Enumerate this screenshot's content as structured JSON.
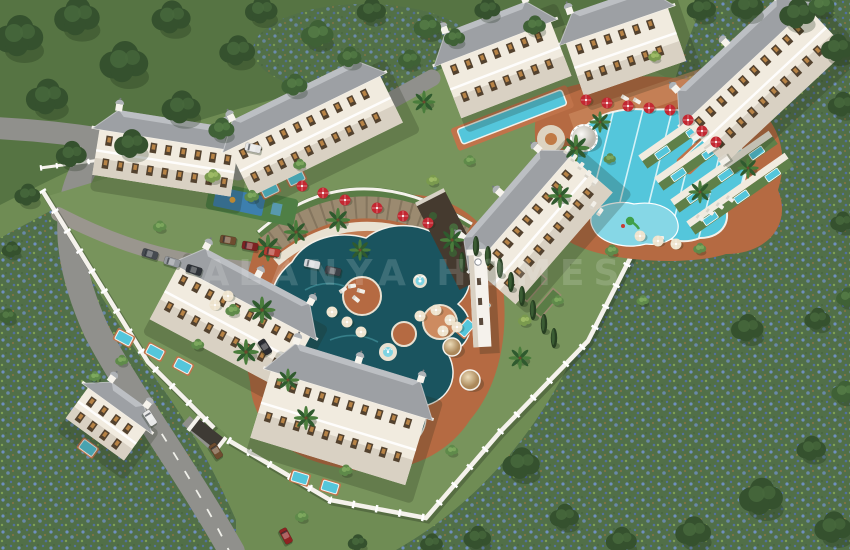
{
  "meta": {
    "subject": "Aerial 3D render of a gated residential complex with pools and gardens"
  },
  "watermark": {
    "text": "ALANYA HOMES"
  },
  "palette": {
    "grass": "#6f8c54",
    "forest_ground": "#567443",
    "lawn": "#78945c",
    "meadow_green": "#516f48",
    "meadow_blue": "#6f8fc0",
    "meadow_blue2": "#53719f",
    "road": "#90908c",
    "road_edge": "#7b7b77",
    "wall": "#f5f2ec",
    "facade": "#f1ebdf",
    "facade_shade": "#d9d1c3",
    "roof": "#9da0a4",
    "roof_light": "#c4c7ca",
    "deck": "#b56a42",
    "deck_light": "#cd8b60",
    "path": "#e9e1d1",
    "pool_dark": "#1a545f",
    "pool_light": "#54c6db",
    "pool_kids": "#86d7e6",
    "stone": "#9b8a70",
    "hedge": "#2f4d2b",
    "parasol_red": "#c32731",
    "parasol_cream": "#eee3cd",
    "window_amber": "#c98e4a"
  },
  "scene": {
    "trees": [
      [
        20,
        42,
        1.5,
        0
      ],
      [
        78,
        22,
        1.4,
        0
      ],
      [
        48,
        102,
        1.3,
        0
      ],
      [
        125,
        68,
        1.5,
        0
      ],
      [
        172,
        22,
        1.2,
        0
      ],
      [
        182,
        112,
        1.2,
        0
      ],
      [
        238,
        55,
        1.1,
        0
      ],
      [
        262,
        14,
        1.0,
        0
      ],
      [
        318,
        38,
        1.0,
        1
      ],
      [
        372,
        14,
        0.9,
        0
      ],
      [
        428,
        30,
        0.85,
        1
      ],
      [
        488,
        12,
        0.8,
        0
      ],
      [
        535,
        28,
        0.7,
        1
      ],
      [
        132,
        148,
        1.05,
        0
      ],
      [
        72,
        158,
        0.95,
        0
      ],
      [
        28,
        198,
        0.8,
        0
      ],
      [
        222,
        132,
        0.8,
        1
      ],
      [
        295,
        88,
        0.8,
        1
      ],
      [
        350,
        60,
        0.75,
        1
      ],
      [
        410,
        62,
        0.7,
        1
      ],
      [
        455,
        40,
        0.65,
        1
      ],
      [
        702,
        12,
        0.9,
        0
      ],
      [
        748,
        10,
        1.0,
        0
      ],
      [
        798,
        18,
        1.1,
        0
      ],
      [
        838,
        52,
        1.0,
        0
      ],
      [
        843,
        108,
        0.9,
        0
      ],
      [
        822,
        8,
        0.8,
        1
      ],
      [
        843,
        225,
        0.75,
        0
      ],
      [
        848,
        300,
        0.7,
        1
      ],
      [
        748,
        332,
        1.0,
        0
      ],
      [
        818,
        322,
        0.8,
        0
      ],
      [
        845,
        395,
        0.8,
        1
      ],
      [
        812,
        452,
        0.9,
        0
      ],
      [
        762,
        502,
        1.35,
        0
      ],
      [
        834,
        532,
        1.15,
        0
      ],
      [
        694,
        536,
        1.1,
        0
      ],
      [
        622,
        544,
        0.95,
        0
      ],
      [
        522,
        468,
        1.15,
        0
      ],
      [
        565,
        520,
        0.9,
        0
      ],
      [
        478,
        541,
        0.85,
        0
      ],
      [
        432,
        546,
        0.7,
        0
      ],
      [
        358,
        545,
        0.6,
        0
      ],
      [
        12,
        252,
        0.6,
        0
      ],
      [
        8,
        318,
        0.55,
        1
      ],
      [
        213,
        178,
        0.5,
        3
      ],
      [
        252,
        198,
        0.45,
        2
      ],
      [
        300,
        166,
        0.4,
        2
      ],
      [
        233,
        312,
        0.45,
        2
      ],
      [
        198,
        346,
        0.4,
        2
      ],
      [
        433,
        182,
        0.4,
        3
      ],
      [
        470,
        162,
        0.38,
        2
      ],
      [
        525,
        322,
        0.42,
        3
      ],
      [
        558,
        302,
        0.38,
        2
      ],
      [
        612,
        252,
        0.42,
        2
      ],
      [
        643,
        302,
        0.38,
        2
      ],
      [
        122,
        362,
        0.4,
        2
      ],
      [
        346,
        472,
        0.42,
        2
      ],
      [
        452,
        452,
        0.4,
        2
      ],
      [
        302,
        518,
        0.42,
        2
      ],
      [
        160,
        228,
        0.42,
        2
      ],
      [
        655,
        58,
        0.4,
        3
      ],
      [
        610,
        160,
        0.38,
        2
      ],
      [
        700,
        250,
        0.4,
        2
      ],
      [
        95,
        378,
        0.38,
        2
      ]
    ],
    "palms": [
      [
        268,
        248,
        1
      ],
      [
        296,
        232,
        0.9
      ],
      [
        338,
        220,
        0.9
      ],
      [
        262,
        310,
        1
      ],
      [
        246,
        352,
        0.95
      ],
      [
        452,
        240,
        0.9
      ],
      [
        576,
        148,
        1
      ],
      [
        560,
        196,
        0.9
      ],
      [
        700,
        192,
        0.85
      ],
      [
        748,
        168,
        0.8
      ],
      [
        424,
        102,
        0.85
      ],
      [
        600,
        122,
        0.8
      ],
      [
        520,
        358,
        0.85
      ],
      [
        360,
        250,
        0.8
      ],
      [
        306,
        418,
        0.9
      ],
      [
        288,
        380,
        0.85
      ]
    ],
    "cypresses": [
      [
        462,
        262
      ],
      [
        476,
        246
      ],
      [
        488,
        256
      ],
      [
        500,
        268
      ],
      [
        511,
        282
      ],
      [
        522,
        296
      ],
      [
        533,
        310
      ],
      [
        544,
        324
      ],
      [
        554,
        338
      ]
    ],
    "parasols_red": [
      [
        586,
        100
      ],
      [
        607,
        103
      ],
      [
        628,
        106
      ],
      [
        649,
        108
      ],
      [
        670,
        110
      ],
      [
        688,
        120
      ],
      [
        702,
        131
      ],
      [
        716,
        142
      ],
      [
        302,
        186
      ],
      [
        323,
        193
      ],
      [
        345,
        200
      ],
      [
        377,
        208
      ],
      [
        403,
        216
      ],
      [
        428,
        223
      ]
    ],
    "parasols_cream": [
      [
        332,
        312
      ],
      [
        347,
        322
      ],
      [
        361,
        332
      ],
      [
        420,
        316
      ],
      [
        436,
        310
      ],
      [
        450,
        320
      ],
      [
        443,
        331
      ],
      [
        457,
        327
      ],
      [
        228,
        296
      ],
      [
        215,
        305
      ],
      [
        640,
        236
      ],
      [
        658,
        241
      ],
      [
        676,
        244
      ]
    ],
    "loungers": [
      [
        567,
        150,
        -55
      ],
      [
        574,
        158,
        -55
      ],
      [
        581,
        166,
        -55
      ],
      [
        588,
        174,
        -55
      ],
      [
        595,
        182,
        -55
      ],
      [
        700,
        218,
        35
      ],
      [
        710,
        212,
        35
      ],
      [
        720,
        206,
        35
      ],
      [
        730,
        199,
        35
      ],
      [
        600,
        212,
        -55
      ],
      [
        593,
        205,
        -55
      ],
      [
        352,
        286,
        -10
      ],
      [
        361,
        291,
        15
      ],
      [
        343,
        290,
        -35
      ],
      [
        356,
        299,
        40
      ],
      [
        625,
        98,
        30
      ],
      [
        637,
        101,
        30
      ],
      [
        660,
        238,
        0
      ],
      [
        676,
        242,
        0
      ]
    ],
    "cars": [
      [
        150,
        418,
        57,
        "#e9e9e9"
      ],
      [
        216,
        451,
        57,
        "#6e4c2f"
      ],
      [
        286,
        536,
        62,
        "#8f2322"
      ],
      [
        265,
        347,
        57,
        "#2b2c30"
      ],
      [
        253,
        148,
        12,
        "#e6e6e6"
      ],
      [
        150,
        254,
        17,
        "#464a50"
      ],
      [
        172,
        262,
        17,
        "#95999e"
      ],
      [
        194,
        270,
        17,
        "#303439"
      ],
      [
        228,
        240,
        10,
        "#6e4c2f"
      ],
      [
        250,
        246,
        10,
        "#7c2222"
      ],
      [
        272,
        252,
        10,
        "#b23b30"
      ],
      [
        312,
        264,
        12,
        "#d4d7da"
      ],
      [
        333,
        271,
        12,
        "#3c4046"
      ]
    ],
    "buildings": [
      {
        "id": "northwest-wing",
        "cx": 165,
        "cy": 163,
        "angle": 9,
        "len": 140,
        "depth": 46
      },
      {
        "id": "north-main",
        "cx": 316,
        "cy": 136,
        "angle": -26,
        "len": 168,
        "depth": 52
      },
      {
        "id": "north-center",
        "cx": 506,
        "cy": 70,
        "angle": -21,
        "len": 118,
        "depth": 58
      },
      {
        "id": "northeast-a",
        "cx": 626,
        "cy": 52,
        "angle": -19,
        "len": 108,
        "depth": 56
      },
      {
        "id": "northeast-b",
        "cx": 766,
        "cy": 86,
        "angle": -43,
        "len": 168,
        "depth": 58
      },
      {
        "id": "east-mid",
        "cx": 543,
        "cy": 230,
        "angle": -49,
        "len": 148,
        "depth": 56
      },
      {
        "id": "west-mid",
        "cx": 230,
        "cy": 328,
        "angle": 28,
        "len": 150,
        "depth": 60
      },
      {
        "id": "south-main",
        "cx": 338,
        "cy": 428,
        "angle": 17,
        "len": 162,
        "depth": 70
      },
      {
        "id": "southwest-small",
        "cx": 106,
        "cy": 424,
        "angle": 36,
        "len": 72,
        "depth": 38
      }
    ],
    "terrace_rows": [
      [
        640,
        158
      ],
      [
        656,
        180
      ],
      [
        672,
        202
      ],
      [
        688,
        224
      ]
    ],
    "private_pools": [
      [
        155,
        352,
        28
      ],
      [
        183,
        366,
        28
      ],
      [
        124,
        338,
        28
      ],
      [
        300,
        478,
        17
      ],
      [
        330,
        487,
        17
      ],
      [
        88,
        448,
        36
      ],
      [
        270,
        190,
        -26
      ],
      [
        296,
        178,
        -26
      ],
      [
        482,
        308,
        -49
      ],
      [
        466,
        328,
        -49
      ]
    ],
    "cabanas": [
      [
        696,
        136
      ],
      [
        710,
        148
      ],
      [
        724,
        160
      ]
    ]
  }
}
